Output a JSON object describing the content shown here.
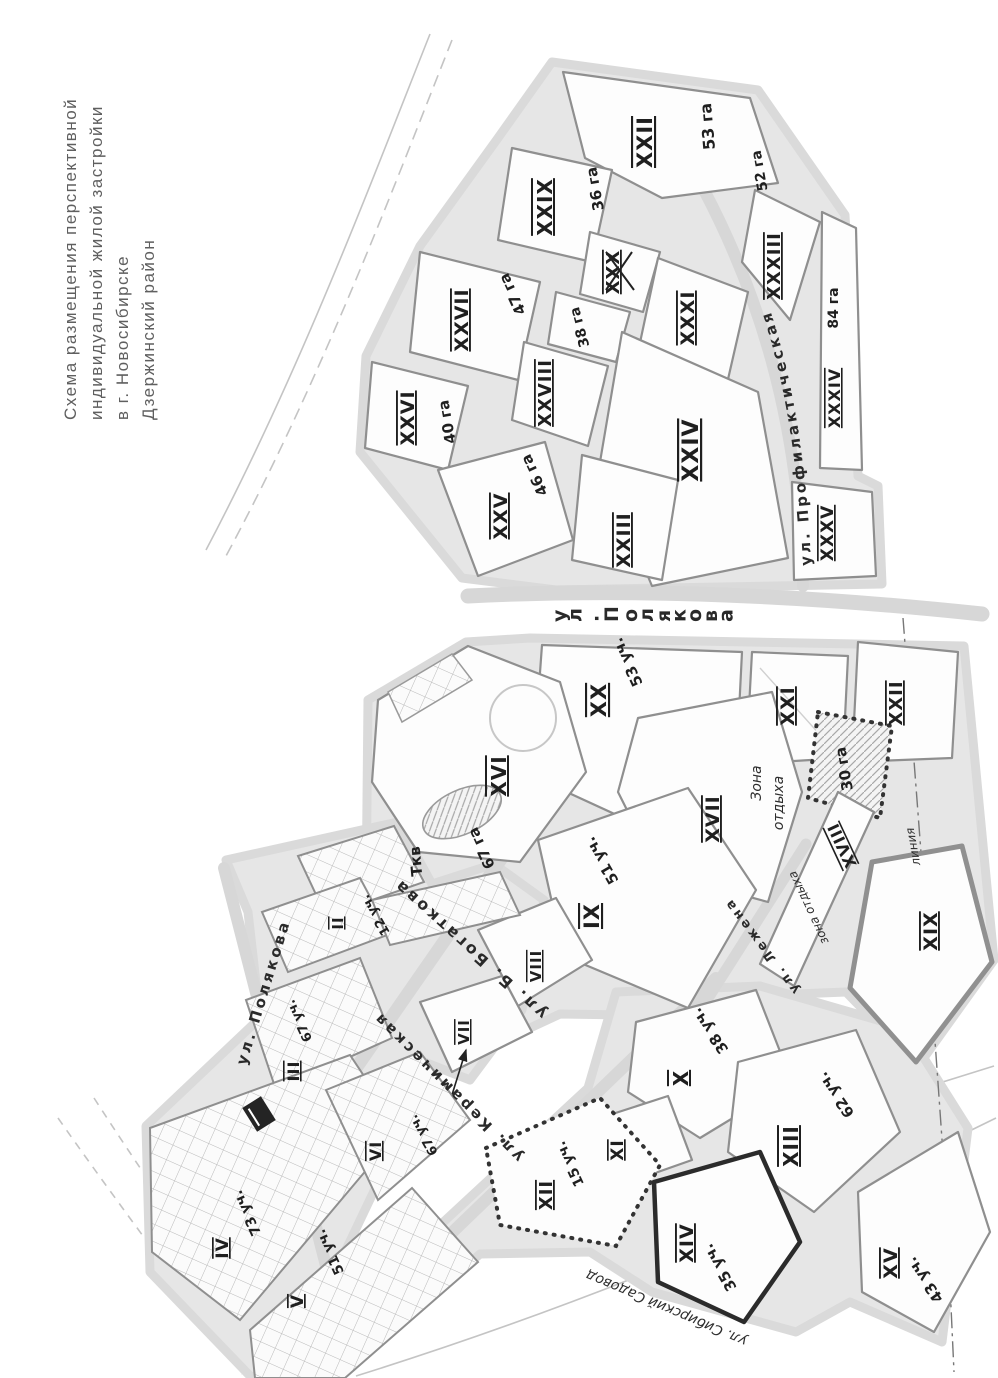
{
  "title": {
    "line1": "Схема размещения перспективной",
    "line2": "индивидуальной жилой застройки",
    "line3": "в г. Новосибирске",
    "line4": "Дзержинский район"
  },
  "map": {
    "streets": {
      "polyakova_main": "ул. Полякова",
      "polyakova_west": "ул. Полякова",
      "profilakticheskaya": "ул. Профилактическая",
      "bogatkova": "ул. Б. Богаткова",
      "keramicheskaya": "ул. Керамическая",
      "lezhena": "ул. Лежена",
      "sadovod": "ул. Сибирский Садовод"
    },
    "annotations": {
      "recreation_zone_line1": "Зона",
      "recreation_zone_line2": "отдыха",
      "recreation_zone_strip": "зона отдыха",
      "utility_point": "Ткв",
      "line_label": "линия"
    },
    "blocks": [
      {
        "numeral": "XXII",
        "area": "53 га"
      },
      {
        "numeral": "XXIX",
        "area": "36 га"
      },
      {
        "numeral": "XXXIII",
        "area": "52 га"
      },
      {
        "numeral": "XXX",
        "area": ""
      },
      {
        "numeral": "XXXI",
        "area": ""
      },
      {
        "numeral": "XXVII",
        "area": "47 га"
      },
      {
        "numeral": "",
        "area": "38 га"
      },
      {
        "numeral": "XXVIII",
        "area": ""
      },
      {
        "numeral": "XXVI",
        "area": "40 га"
      },
      {
        "numeral": "XXV",
        "area": "46 га"
      },
      {
        "numeral": "XXIV",
        "area": ""
      },
      {
        "numeral": "XXIII",
        "area": ""
      },
      {
        "numeral": "XXXIV",
        "area": "84 га"
      },
      {
        "numeral": "XXXV",
        "area": ""
      },
      {
        "numeral": "XX",
        "area": "53 уч."
      },
      {
        "numeral": "XXI",
        "area": ""
      },
      {
        "numeral": "XXII",
        "area": ""
      },
      {
        "numeral": "",
        "area": "30 га"
      },
      {
        "numeral": "XVIII",
        "area": ""
      },
      {
        "numeral": "XIX",
        "area": ""
      },
      {
        "numeral": "XVII",
        "area": ""
      },
      {
        "numeral": "XVI",
        "area": "67 га"
      },
      {
        "numeral": "IX",
        "area": "51 уч."
      },
      {
        "numeral": "VIII",
        "area": ""
      },
      {
        "numeral": "VII",
        "area": ""
      },
      {
        "numeral": "X",
        "area": "38 уч."
      },
      {
        "numeral": "XI",
        "area": ""
      },
      {
        "numeral": "XII",
        "area": "15 уч."
      },
      {
        "numeral": "XIII",
        "area": "62 уч."
      },
      {
        "numeral": "XIV",
        "area": "35 уч."
      },
      {
        "numeral": "XV",
        "area": "43 уч."
      },
      {
        "numeral": "II",
        "area": "12 уч."
      },
      {
        "numeral": "III",
        "area": "67 уч."
      },
      {
        "numeral": "IV",
        "area": "73 уч."
      },
      {
        "numeral": "V",
        "area": "51 уч."
      },
      {
        "numeral": "VI",
        "area": "67 уч."
      }
    ]
  }
}
